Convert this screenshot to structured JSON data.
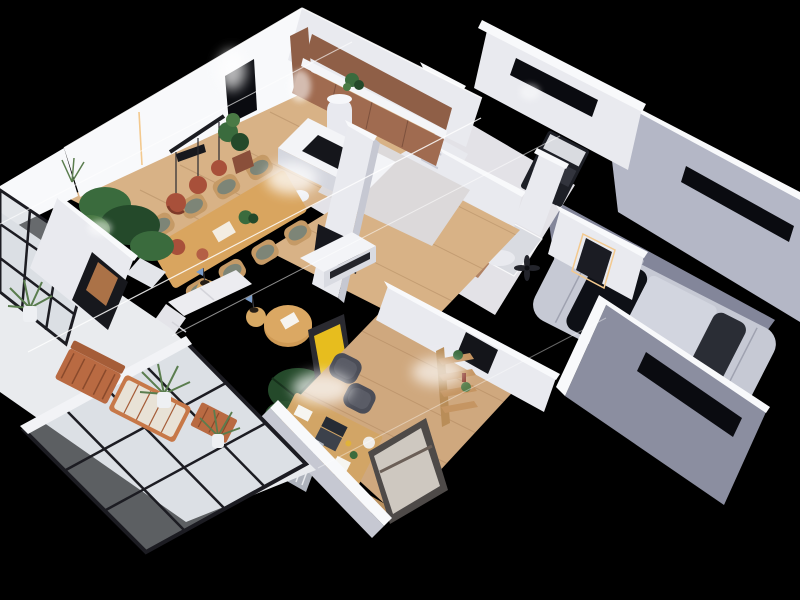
{
  "scene": {
    "description": "3D isometric cutaway render of a single-storey home floor plan viewed from above, on a pure black background",
    "style": "photorealistic architectural visualization; walls sliced horizontally with bright white cut tops, thin white section lines, warm LED accents and soft smoke wisps",
    "background": "#000000",
    "rooms": [
      {
        "name": "kitchen",
        "objects": [
          "brown wood wall cabinets",
          "white counter",
          "white island with black cooktop",
          "round white column",
          "counter plant",
          "white bar stool"
        ]
      },
      {
        "name": "dining-area",
        "objects": [
          "long wooden table",
          "eight wooden chairs with sage cushions",
          "three terracotta pendant lamps",
          "terracotta vases",
          "plant centerpiece",
          "black wall heater",
          "corner monstera plants",
          "fiddle-leaf plant",
          "black window opening",
          "warm LED strip"
        ]
      },
      {
        "name": "living-area",
        "objects": [
          "white TV cabinet",
          "dark TV panel",
          "tall white chimney pillar",
          "round wooden coffee table with paper",
          "white modular sofa",
          "two tan sphere vases",
          "dark palm plant",
          "yellow artwork in dark frame"
        ]
      },
      {
        "name": "hallway-stairs",
        "objects": [
          "white staircase with white railing",
          "marble floor",
          "dark ceiling fan"
        ]
      },
      {
        "name": "bathroom",
        "objects": [
          "wood vanity with white basin",
          "round rattan mirror",
          "glass shower with white tray",
          "toilet",
          "small plant box",
          "terracotta floor tiles"
        ]
      },
      {
        "name": "laundry-nook",
        "objects": [
          "black appliance rack",
          "stacked white unit",
          "blue indicator lights"
        ]
      },
      {
        "name": "entry",
        "objects": [
          "white partition walls",
          "dark door opening with warm LED frame to garage"
        ]
      },
      {
        "name": "home-office",
        "objects": [
          "wooden desk",
          "laptop",
          "white papers",
          "desk lamp",
          "two dark chairs",
          "curved wooden shelf with plants",
          "large wood-framed window",
          "striped radiator panel",
          "black door opening",
          "wood bench sill"
        ]
      },
      {
        "name": "patio",
        "objects": [
          "white tiled floor",
          "black-framed glass walls",
          "wooden bench",
          "wooden lounge chair",
          "wooden side table",
          "potted palms",
          "dark doorway with framed artwork"
        ]
      },
      {
        "name": "garage",
        "objects": [
          "silver car with black glass canopy",
          "gray concrete floor",
          "long black slot windows",
          "gray exterior walls with white cut tops"
        ]
      }
    ]
  },
  "palette": {
    "background": "#000000",
    "wall_white": "#e9eaef",
    "wall_bright": "#f8f9fb",
    "wall_shadow": "#c6c8d2",
    "wall_dark": "#aaacba",
    "floor_wood": "#d8b286",
    "floor_office": "#cfa87e",
    "floor_marble": "#dcd9da",
    "floor_patio": "#e9ebee",
    "floor_garage": "#83869a",
    "garage_wall": "#b4b7c6",
    "garage_wall_dark": "#8b8ea0",
    "window_black": "#0a0b10",
    "cabinet_brown": "#8f5f47",
    "cabinet_brown_light": "#a06b50",
    "table_wood": "#d9a55f",
    "chair_wood": "#c59a66",
    "cushion_green": "#7d8577",
    "terracotta": "#a8503a",
    "plant_green": "#3a6b3d",
    "plant_dark": "#24492a",
    "palm_green": "#5a7d4e",
    "car_silver": "#c6c9d4",
    "car_glass": "#0e1016",
    "art_yellow": "#e7bd1e",
    "frame_dark": "#2a2a30",
    "led_warm": "#f3c98e",
    "cut_line": "#ffffff",
    "glass_tint": "#cdd3da",
    "glass_frame": "#1c1c22",
    "desk_wood": "#d2a566",
    "chair_dark": "#4b4d57",
    "sofa_white": "#ececf0",
    "vase_tan": "#d8a964",
    "appliance_dark": "#1d1f26",
    "tile_bath": "#b08264"
  }
}
